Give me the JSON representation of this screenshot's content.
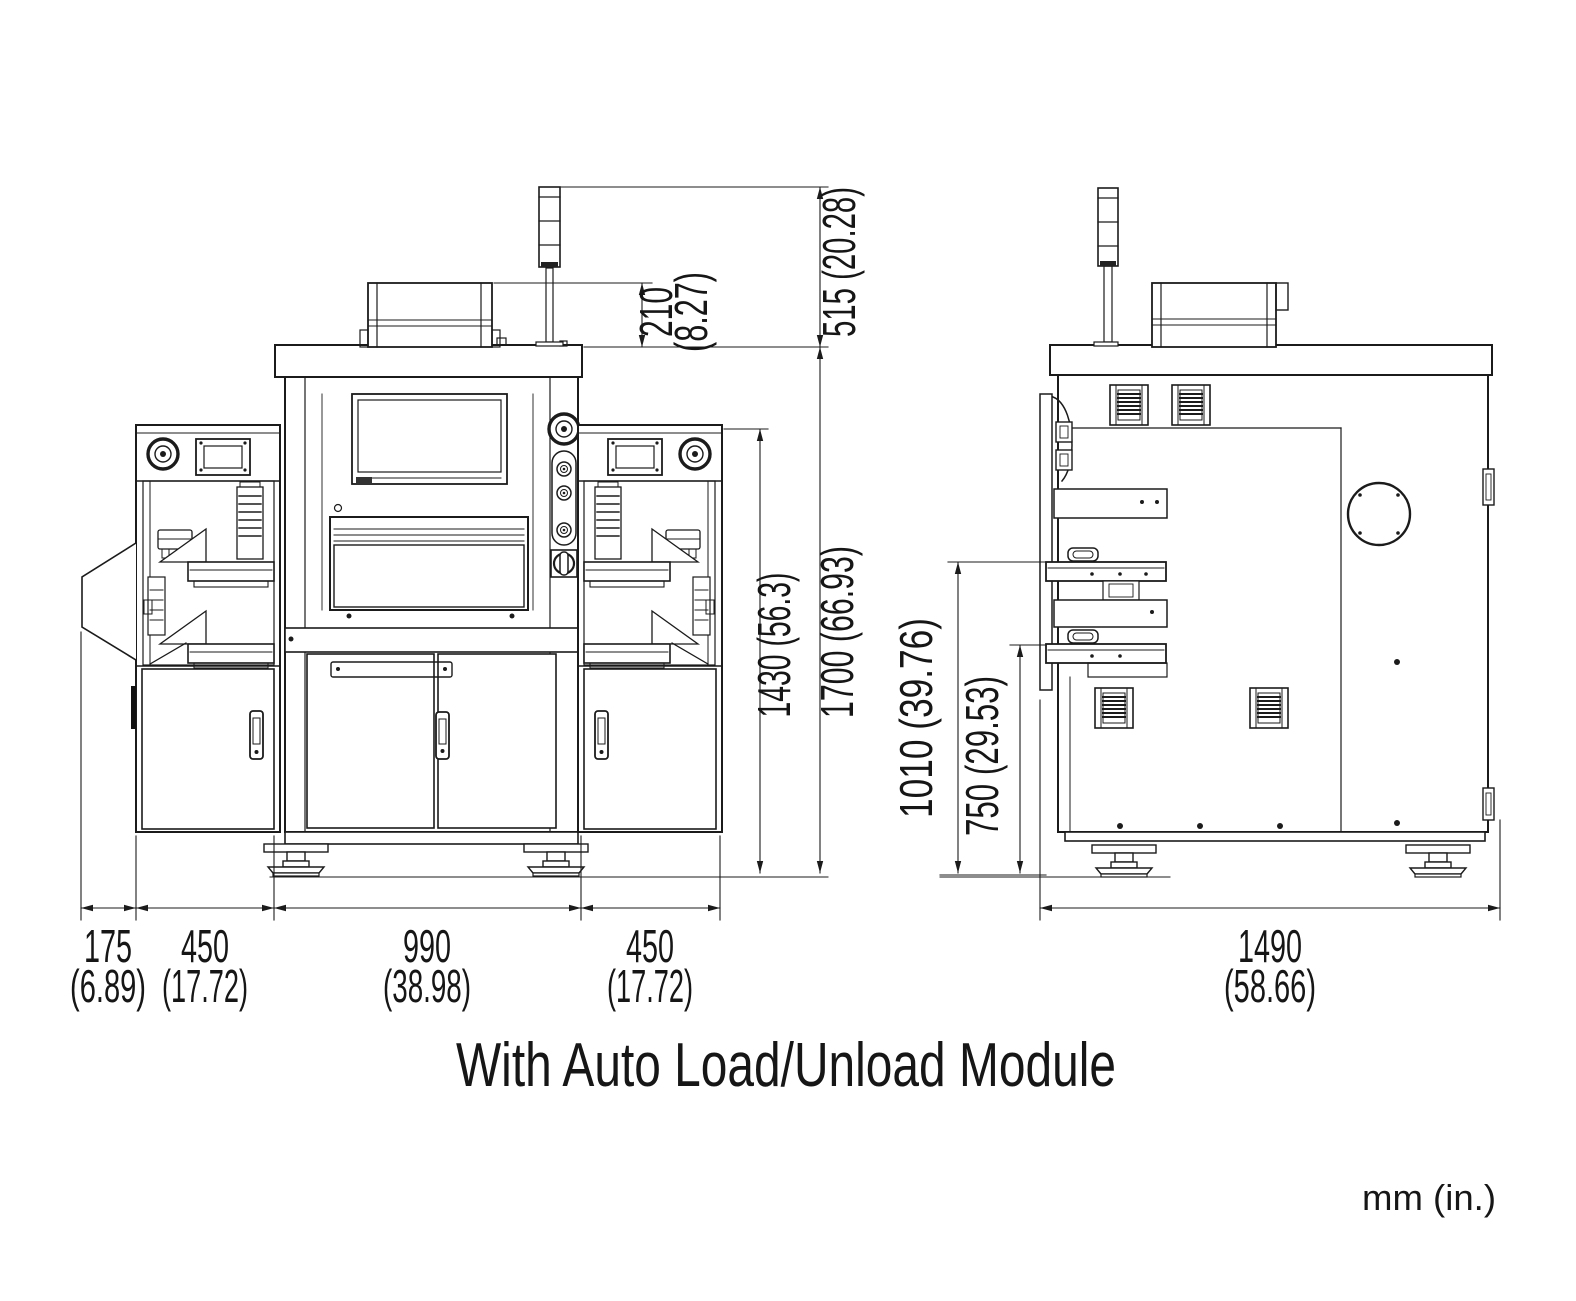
{
  "title": "With Auto Load/Unload Module",
  "units_note": "mm (in.)",
  "line_color": "#1b1b1b",
  "front_view": {
    "dims": {
      "top_box_height_mm": "210",
      "top_box_height_in": "(8.27)",
      "signal_tower_height": "515 (20.28)",
      "module_height": "1430 (56.3)",
      "overall_height": "1700 (66.93)",
      "chute_width_mm": "175",
      "chute_width_in": "(6.89)",
      "left_module_width_mm": "450",
      "left_module_width_in": "(17.72)",
      "center_width_mm": "990",
      "center_width_in": "(38.98)",
      "right_module_width_mm": "450",
      "right_module_width_in": "(17.72)"
    }
  },
  "side_view": {
    "dims": {
      "upper_tray_height": "1010 (39.76)",
      "lower_tray_height": "750 (29.53)",
      "depth_mm": "1490",
      "depth_in": "(58.66)"
    }
  }
}
